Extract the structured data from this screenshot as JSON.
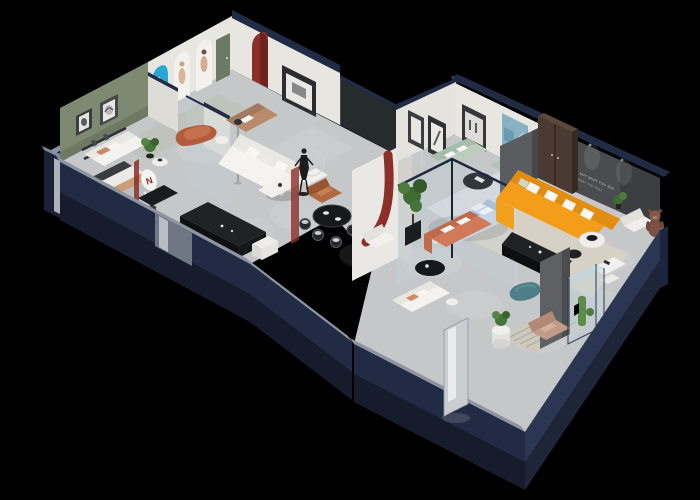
{
  "scene": {
    "type": "isometric-3d-floorplan-render",
    "subject": "Cutaway 3D floor plan of a furniture showroom on a black background, navy exterior walls, two angled wings",
    "background": "#000000",
    "colors": {
      "background": "#000000",
      "wall_navy": "#222b44",
      "wall_navy_dark": "#161d30",
      "wall_rim": "#8d95a3",
      "floor": "#c6c7c9",
      "interior_wall": "#e8e6e1",
      "sage_wall": "#7d8a71",
      "green_door": "#6b7a64",
      "blue_arch": "#28a7d4",
      "red_accent": "#8c2f28",
      "charcoal_wall": "#4a4c50",
      "orange_sofa": "#f49d1a",
      "copper_ottoman": "#b05c3d",
      "tan_sofa": "#b98a6c",
      "sage_sofa": "#bccdbd",
      "coral_sofa": "#d07a5a",
      "teal_ottoman": "#4e7f88",
      "bed_blue": "#c8d6e7",
      "plant_green": "#46743a",
      "rug_beige": "#d7d1c5",
      "wood_brown": "#4b3a31",
      "glass_tint": "#bcd6e6",
      "black_furniture": "#17181b",
      "white_furniture": "#f0efeb"
    },
    "texts": {
      "wall_slogan_line1": "LIFE IS NOT WHAT YOU SEE",
      "wall_slogan_line2": "IT IS WHAT YOU FEEL",
      "arch_digit": "8",
      "arch_poster_number": "888",
      "oval_sign_letter": "N"
    },
    "rooms": [
      {
        "name": "display-gallery",
        "wall": "sage green with arched niches",
        "furniture": [
          "white sofa",
          "copper ottoman",
          "tan leather sofa",
          "round side tables",
          "potted plant",
          "blue arch poster",
          "arched art niches",
          "green door"
        ]
      },
      {
        "name": "white-living-display",
        "furniture": [
          "white L-sectional sofa",
          "white coffee table",
          "caramel armchair",
          "floor lamp",
          "black wall art",
          "red arch niche"
        ]
      },
      {
        "name": "office-bedroom-display",
        "furniture": [
          "bed with tan throw",
          "wall shelf",
          "black desk",
          "desk chair",
          "oval brand sign",
          "black media console",
          "white stool"
        ]
      },
      {
        "name": "dining-display",
        "furniture": [
          "black dining table",
          "dining chairs",
          "mannequin statue",
          "ring light"
        ]
      },
      {
        "name": "entry-column",
        "furniture": [
          "white column with red J motif"
        ]
      },
      {
        "name": "green-sofa-lounge",
        "furniture": [
          "sage green sofa",
          "black oval coffee table",
          "sage chaise",
          "dark art frames",
          "teal botanical poster",
          "brown wardrobe"
        ]
      },
      {
        "name": "glass-bedroom-display",
        "furniture": [
          "light blue bed",
          "white pillows",
          "bedside bench",
          "glass partitions",
          "tall potted plant",
          "gray panel"
        ]
      },
      {
        "name": "orange-living-display",
        "furniture": [
          "orange L-shaped sofa",
          "white throw pillows",
          "black media console",
          "white round coffee table",
          "black side table",
          "white armchair",
          "teddy bear figure",
          "white desk and chair",
          "beige area rug",
          "charcoal slogan wall"
        ]
      },
      {
        "name": "coral-lounge",
        "furniture": [
          "coral sofa",
          "black oval coffee table",
          "white armchair"
        ]
      },
      {
        "name": "rear-lounge",
        "furniture": [
          "white sofa",
          "plant pedestal",
          "teal ottoman",
          "beige armchair",
          "gray partition",
          "glass display case with cactus",
          "striped rug",
          "full-length mirror"
        ]
      }
    ]
  }
}
